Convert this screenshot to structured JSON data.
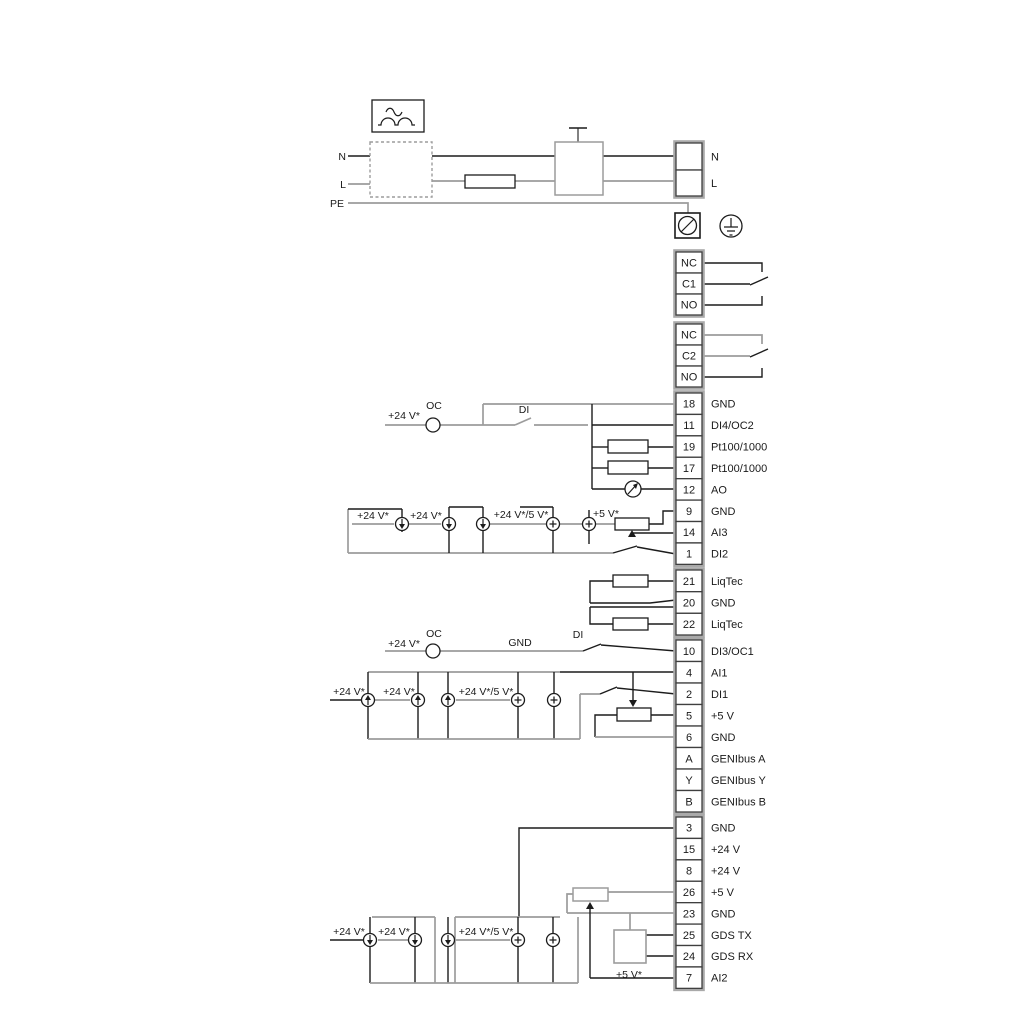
{
  "colors": {
    "wire_black": "#1c1c1c",
    "wire_gray": "#9c9c9c",
    "cell_border": "#3f3f3f",
    "strip_border": "#a9a9a9",
    "text": "#1a1a1a"
  },
  "mains": {
    "left_labels": [
      "N",
      "L",
      "PE"
    ],
    "right_labels": [
      "N",
      "L"
    ]
  },
  "terminal_groups": [
    {
      "name": "mains-block",
      "cells": [
        {
          "id": "",
          "label": "N"
        },
        {
          "id": "",
          "label": "L"
        }
      ]
    },
    {
      "name": "relay-1",
      "cells": [
        {
          "id": "NC",
          "label": ""
        },
        {
          "id": "C1",
          "label": ""
        },
        {
          "id": "NO",
          "label": ""
        }
      ]
    },
    {
      "name": "relay-2",
      "cells": [
        {
          "id": "NC",
          "label": ""
        },
        {
          "id": "C2",
          "label": ""
        },
        {
          "id": "NO",
          "label": ""
        }
      ]
    },
    {
      "name": "io-top",
      "cells": [
        {
          "id": "18",
          "label": "GND"
        },
        {
          "id": "11",
          "label": "DI4/OC2"
        },
        {
          "id": "19",
          "label": "Pt100/1000"
        },
        {
          "id": "17",
          "label": "Pt100/1000"
        },
        {
          "id": "12",
          "label": "AO"
        },
        {
          "id": "9",
          "label": "GND"
        },
        {
          "id": "14",
          "label": "AI3"
        },
        {
          "id": "1",
          "label": "DI2"
        }
      ]
    },
    {
      "name": "liqtec",
      "cells": [
        {
          "id": "21",
          "label": "LiqTec"
        },
        {
          "id": "20",
          "label": "GND"
        },
        {
          "id": "22",
          "label": "LiqTec"
        }
      ]
    },
    {
      "name": "io-mid",
      "cells": [
        {
          "id": "10",
          "label": "DI3/OC1"
        },
        {
          "id": "4",
          "label": "AI1"
        },
        {
          "id": "2",
          "label": "DI1"
        },
        {
          "id": "5",
          "label": "+5 V"
        },
        {
          "id": "6",
          "label": "GND"
        },
        {
          "id": "A",
          "label": "GENIbus A"
        },
        {
          "id": "Y",
          "label": "GENIbus Y"
        },
        {
          "id": "B",
          "label": "GENIbus B"
        }
      ]
    },
    {
      "name": "io-bottom",
      "cells": [
        {
          "id": "3",
          "label": "GND"
        },
        {
          "id": "15",
          "label": "+24 V"
        },
        {
          "id": "8",
          "label": "+24 V"
        },
        {
          "id": "26",
          "label": "+5 V"
        },
        {
          "id": "23",
          "label": "GND"
        },
        {
          "id": "25",
          "label": "GDS TX"
        },
        {
          "id": "24",
          "label": "GDS RX"
        },
        {
          "id": "7",
          "label": "AI2"
        }
      ]
    }
  ],
  "annotations": [
    {
      "id": "mains-n-left",
      "text": "N",
      "x": 346,
      "y": 160,
      "a": "end"
    },
    {
      "id": "mains-l-left",
      "text": "L",
      "x": 346,
      "y": 188,
      "a": "end"
    },
    {
      "id": "mains-pe-left",
      "text": "PE",
      "x": 344,
      "y": 207,
      "a": "end"
    },
    {
      "id": "di4-supply",
      "text": "+24 V*",
      "x": 420,
      "y": 419,
      "a": "end"
    },
    {
      "id": "di4-oc",
      "text": "OC",
      "x": 434,
      "y": 409,
      "a": "middle"
    },
    {
      "id": "di4-di",
      "text": "DI",
      "x": 524,
      "y": 413,
      "a": "middle"
    },
    {
      "id": "ai3-24v-1",
      "text": "+24 V*",
      "x": 373,
      "y": 519,
      "a": "middle"
    },
    {
      "id": "ai3-24v-2",
      "text": "+24 V*",
      "x": 426,
      "y": 519,
      "a": "middle"
    },
    {
      "id": "ai3-24v-5v",
      "text": "+24 V*/5 V*",
      "x": 521,
      "y": 518,
      "a": "middle"
    },
    {
      "id": "ai3-5v",
      "text": "+5 V*",
      "x": 606,
      "y": 517,
      "a": "middle"
    },
    {
      "id": "di3-supply",
      "text": "+24 V*",
      "x": 420,
      "y": 647,
      "a": "end"
    },
    {
      "id": "di3-oc",
      "text": "OC",
      "x": 434,
      "y": 637,
      "a": "middle"
    },
    {
      "id": "di3-gnd",
      "text": "GND",
      "x": 520,
      "y": 646,
      "a": "middle"
    },
    {
      "id": "di3-di",
      "text": "DI",
      "x": 578,
      "y": 638,
      "a": "middle"
    },
    {
      "id": "ai1-24v-1",
      "text": "+24 V*",
      "x": 349,
      "y": 695,
      "a": "middle"
    },
    {
      "id": "ai1-24v-2",
      "text": "+24 V*",
      "x": 399,
      "y": 695,
      "a": "middle"
    },
    {
      "id": "ai1-24v-5v",
      "text": "+24 V*/5 V*",
      "x": 486,
      "y": 695,
      "a": "middle"
    },
    {
      "id": "ai2-24v-1",
      "text": "+24 V*",
      "x": 349,
      "y": 935,
      "a": "middle"
    },
    {
      "id": "ai2-24v-2",
      "text": "+24 V*",
      "x": 394,
      "y": 935,
      "a": "middle"
    },
    {
      "id": "ai2-24v-5v",
      "text": "+24 V*/5 V*",
      "x": 486,
      "y": 935,
      "a": "middle"
    },
    {
      "id": "ai2-5v",
      "text": "+5 V*",
      "x": 629,
      "y": 978,
      "a": "middle"
    }
  ]
}
